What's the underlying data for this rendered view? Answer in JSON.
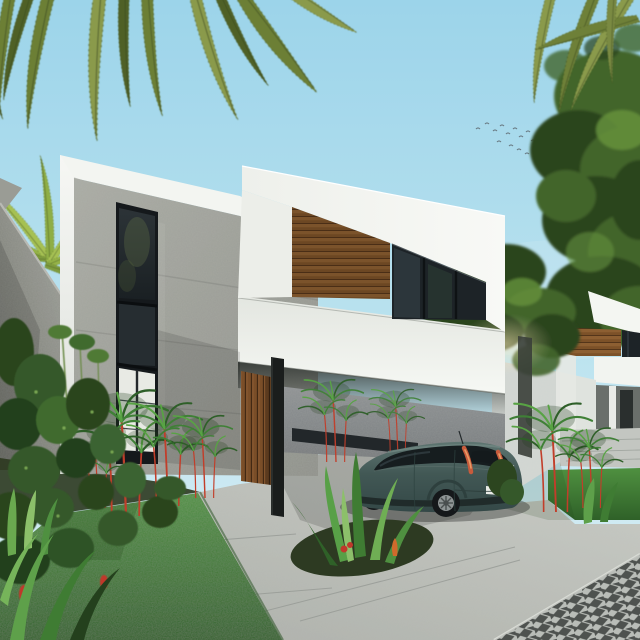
{
  "meta": {
    "title": "Modern tropical two-storey house exterior render",
    "canvas": {
      "width": 640,
      "height": 640
    },
    "time_of_day": "day",
    "text_content": "none"
  },
  "scene": {
    "sky": {
      "description": "clear light-blue sky, hazier near horizon",
      "birds_count": 16
    },
    "vegetation": {
      "palm_fronds": "overhanging from top-left and top-right corners",
      "palm_crown_left": "bright palm crown behind left boundary wall",
      "tree_right": "large leafy tree along right edge",
      "tree_between_houses": "foliage mass between the two houses",
      "lawn": "front lawn at bottom-left",
      "accent_plants": "red-stemmed lipstick palms, spiky dracaena clumps, low shrubs, small red flowers"
    },
    "buildings": [
      {
        "name": "main-house",
        "storeys": 2,
        "style": "modern minimalist",
        "materials": [
          "white render",
          "board-form concrete",
          "horizontal wood-plank cladding",
          "dark glazing"
        ],
        "features": [
          "cantilevered upper volume",
          "double-height vertical window strip",
          "carport",
          "vertical wood-slat entry door",
          "black steel column",
          "long dark slot opening in carport back wall"
        ]
      },
      {
        "name": "neighbor-house-right",
        "storeys": 2,
        "materials": [
          "white render",
          "wood-slat band",
          "dark glazing"
        ],
        "features": [
          "white fascia bands",
          "shaded porch",
          "own walkway and grass strip"
        ]
      }
    ],
    "vehicle": {
      "type": "hatchback",
      "color_name": "dark teal",
      "view": "rear three-quarter from left",
      "details": [
        "vertical red tail-light strips on rear pillars",
        "blank white license plate",
        "alloy wheels",
        "short roof antenna"
      ]
    },
    "ground": {
      "driveway": "poured concrete slabs with faint joints",
      "walkway": "concrete path between lawn and garden bed",
      "road": "dark diamond-pattern paver road at bottom-right corner"
    }
  },
  "colors": {
    "sky_top": "#9cd4ea",
    "sky_bottom": "#dceff5",
    "frond_dark": "#4f6128",
    "frond_mid": "#6c7f36",
    "frond_light": "#8a9a4c",
    "palm_crown": "#94b246",
    "tree_dark": "#2c451f",
    "tree_mid": "#42652c",
    "tree_light": "#65913c",
    "white_bright": "#f7f8f4",
    "white_soft": "#e9ece7",
    "white_shade": "#cdd1cc",
    "concrete_light": "#a9aba4",
    "concrete_mid": "#90928b",
    "concrete_dark": "#787a72",
    "wood_light": "#9a6a3a",
    "wood_mid": "#7c5128",
    "wood_dark": "#4f3117",
    "glass_dark": "#1d2327",
    "glass_mid": "#323d43",
    "car_body": "#344847",
    "car_body_light": "#5f7672",
    "car_glass": "#161d1f",
    "taillight": "#c75b3c",
    "plate": "#e9ebe6",
    "grass_light": "#4f9040",
    "grass_dark": "#2f6128",
    "stem_red": "#c23e2a",
    "leaf_green": "#3f8036",
    "pave_grout": "#cfd3cd",
    "paver_dark": "#575c59",
    "soil_dark": "#2c381f",
    "column_black": "#1a1d1c",
    "bird_gray": "#5f6a72",
    "interior_light": "#e8eae4"
  }
}
